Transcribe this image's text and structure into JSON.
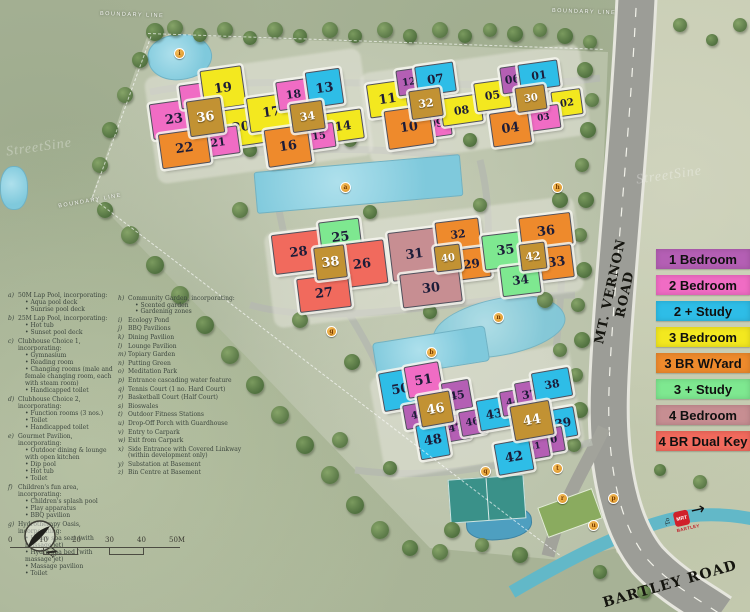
{
  "legend": {
    "items": [
      {
        "label": "1 Bedroom",
        "color": "#b45fb4"
      },
      {
        "label": "2 Bedroom",
        "color": "#f06cc4"
      },
      {
        "label": "2 + Study",
        "color": "#2ebde7"
      },
      {
        "label": "3 Bedroom",
        "color": "#f3e81f"
      },
      {
        "label": "3 BR W/Yard",
        "color": "#ee8a2c"
      },
      {
        "label": "3 + Study",
        "color": "#7ee890"
      },
      {
        "label": "4 Bedroom",
        "color": "#c78e92"
      },
      {
        "label": "4 BR Dual Key",
        "color": "#f16a5d"
      }
    ]
  },
  "unit_colors": {
    "1bed": "#b45fb4",
    "2bed": "#f06cc4",
    "2study": "#2ebde7",
    "3bed": "#f3e81f",
    "3yard": "#ee8a2c",
    "3study": "#7ee890",
    "4bed": "#c78e92",
    "4dual": "#f16a5d",
    "tower": "#c29233"
  },
  "roads": {
    "vernon": "MT. VERNON ROAD",
    "bartley": "BARTLEY ROAD",
    "mrt_to": "To",
    "mrt_logo": "MRT",
    "mrt_station": "BARTLEY",
    "mrt_arrow": "→"
  },
  "compass": {
    "north": "N"
  },
  "watermark": {
    "text": "StreetSine"
  },
  "scalebar": {
    "ticks": [
      "0",
      "10",
      "20",
      "30",
      "40",
      "50M"
    ]
  },
  "boundary_labels": [
    {
      "text": "BOUNDARY LINE",
      "x": 100,
      "y": 12,
      "r": 2
    },
    {
      "text": "BOUNDARY LINE",
      "x": 552,
      "y": 9,
      "r": 2
    },
    {
      "text": "BOUNDARY LINE",
      "x": 58,
      "y": 198,
      "r": -10
    }
  ],
  "buildings": [
    {
      "n": "23",
      "t": "2bed",
      "x": 151,
      "y": 101,
      "w": 44,
      "h": 34,
      "r": -8
    },
    {
      "n": "",
      "t": "2bed",
      "x": 180,
      "y": 84,
      "w": 22,
      "h": 22,
      "r": -8
    },
    {
      "n": "19",
      "t": "3bed",
      "x": 202,
      "y": 68,
      "w": 40,
      "h": 38,
      "r": -8
    },
    {
      "n": "20",
      "t": "3bed",
      "x": 219,
      "y": 108,
      "w": 42,
      "h": 36,
      "r": -8
    },
    {
      "n": "36",
      "t": "tower",
      "x": 188,
      "y": 99,
      "w": 33,
      "h": 34,
      "r": -8
    },
    {
      "n": "21",
      "t": "2bed",
      "x": 197,
      "y": 128,
      "w": 40,
      "h": 26,
      "r": -8
    },
    {
      "n": "22",
      "t": "3yard",
      "x": 160,
      "y": 131,
      "w": 47,
      "h": 33,
      "r": -8
    },
    {
      "n": "17",
      "t": "3bed",
      "x": 248,
      "y": 95,
      "w": 45,
      "h": 33,
      "r": -8
    },
    {
      "n": "18",
      "t": "2bed",
      "x": 277,
      "y": 80,
      "w": 31,
      "h": 27,
      "r": -8
    },
    {
      "n": "13",
      "t": "2study",
      "x": 307,
      "y": 70,
      "w": 33,
      "h": 34,
      "r": -8
    },
    {
      "n": "34",
      "t": "tower",
      "x": 291,
      "y": 102,
      "w": 31,
      "h": 27,
      "r": -8
    },
    {
      "n": "14",
      "t": "3bed",
      "x": 323,
      "y": 111,
      "w": 38,
      "h": 28,
      "r": -8
    },
    {
      "n": "15",
      "t": "2bed",
      "x": 303,
      "y": 124,
      "w": 30,
      "h": 23,
      "r": -8
    },
    {
      "n": "16",
      "t": "3yard",
      "x": 266,
      "y": 127,
      "w": 42,
      "h": 36,
      "r": -8
    },
    {
      "n": "11",
      "t": "3bed",
      "x": 368,
      "y": 82,
      "w": 37,
      "h": 32,
      "r": -8
    },
    {
      "n": "12",
      "t": "1bed",
      "x": 397,
      "y": 69,
      "w": 22,
      "h": 24,
      "r": -8
    },
    {
      "n": "07",
      "t": "2study",
      "x": 416,
      "y": 64,
      "w": 37,
      "h": 28,
      "r": -8
    },
    {
      "n": "32",
      "t": "tower",
      "x": 410,
      "y": 89,
      "w": 30,
      "h": 27,
      "r": -8
    },
    {
      "n": "09",
      "t": "2bed",
      "x": 421,
      "y": 110,
      "w": 28,
      "h": 25,
      "r": -8
    },
    {
      "n": "08",
      "t": "3bed",
      "x": 441,
      "y": 96,
      "w": 39,
      "h": 26,
      "r": -8
    },
    {
      "n": "10",
      "t": "3yard",
      "x": 386,
      "y": 108,
      "w": 44,
      "h": 37,
      "r": -8
    },
    {
      "n": "05",
      "t": "3bed",
      "x": 475,
      "y": 81,
      "w": 33,
      "h": 27,
      "r": -8
    },
    {
      "n": "06",
      "t": "1bed",
      "x": 501,
      "y": 66,
      "w": 21,
      "h": 25,
      "r": -8
    },
    {
      "n": "01",
      "t": "2study",
      "x": 519,
      "y": 62,
      "w": 38,
      "h": 25,
      "r": -8
    },
    {
      "n": "30",
      "t": "tower",
      "x": 516,
      "y": 86,
      "w": 28,
      "h": 23,
      "r": -8
    },
    {
      "n": "02",
      "t": "3bed",
      "x": 552,
      "y": 90,
      "w": 28,
      "h": 24,
      "r": -8
    },
    {
      "n": "03",
      "t": "2bed",
      "x": 527,
      "y": 106,
      "w": 31,
      "h": 22,
      "r": -8
    },
    {
      "n": "04",
      "t": "3yard",
      "x": 491,
      "y": 111,
      "w": 37,
      "h": 32,
      "r": -8
    },
    {
      "n": "28",
      "t": "4dual",
      "x": 273,
      "y": 232,
      "w": 49,
      "h": 38,
      "r": -7
    },
    {
      "n": "25",
      "t": "3study",
      "x": 320,
      "y": 220,
      "w": 39,
      "h": 33,
      "r": -7
    },
    {
      "n": "38",
      "t": "tower",
      "x": 315,
      "y": 246,
      "w": 29,
      "h": 31,
      "r": -7
    },
    {
      "n": "26",
      "t": "4dual",
      "x": 338,
      "y": 242,
      "w": 46,
      "h": 42,
      "r": -7
    },
    {
      "n": "27",
      "t": "4dual",
      "x": 298,
      "y": 276,
      "w": 50,
      "h": 32,
      "r": -7
    },
    {
      "n": "31",
      "t": "4bed",
      "x": 390,
      "y": 230,
      "w": 47,
      "h": 47,
      "r": -7
    },
    {
      "n": "32",
      "t": "3yard",
      "x": 436,
      "y": 220,
      "w": 42,
      "h": 27,
      "r": -7
    },
    {
      "n": "40",
      "t": "tower",
      "x": 435,
      "y": 245,
      "w": 24,
      "h": 24,
      "r": -7
    },
    {
      "n": "29",
      "t": "3yard",
      "x": 453,
      "y": 248,
      "w": 35,
      "h": 29,
      "r": -7
    },
    {
      "n": "30",
      "t": "4bed",
      "x": 401,
      "y": 271,
      "w": 58,
      "h": 32,
      "r": -7
    },
    {
      "n": "35",
      "t": "3study",
      "x": 483,
      "y": 233,
      "w": 43,
      "h": 33,
      "r": -7
    },
    {
      "n": "36",
      "t": "3yard",
      "x": 520,
      "y": 215,
      "w": 50,
      "h": 30,
      "r": -7
    },
    {
      "n": "42",
      "t": "tower",
      "x": 520,
      "y": 243,
      "w": 24,
      "h": 25,
      "r": -7
    },
    {
      "n": "33",
      "t": "3yard",
      "x": 540,
      "y": 246,
      "w": 31,
      "h": 31,
      "r": -7
    },
    {
      "n": "34",
      "t": "3study",
      "x": 501,
      "y": 265,
      "w": 37,
      "h": 28,
      "r": -7
    },
    {
      "n": "50",
      "t": "2study",
      "x": 381,
      "y": 370,
      "w": 37,
      "h": 37,
      "r": -10
    },
    {
      "n": "51",
      "t": "2bed",
      "x": 406,
      "y": 364,
      "w": 33,
      "h": 30,
      "r": -10
    },
    {
      "n": "45",
      "t": "1bed",
      "x": 443,
      "y": 381,
      "w": 26,
      "h": 27,
      "r": -10
    },
    {
      "n": "46",
      "t": "tower",
      "x": 419,
      "y": 393,
      "w": 31,
      "h": 30,
      "r": -10
    },
    {
      "n": "49",
      "t": "1bed",
      "x": 404,
      "y": 403,
      "w": 26,
      "h": 23,
      "r": -10
    },
    {
      "n": "47",
      "t": "1bed",
      "x": 442,
      "y": 415,
      "w": 25,
      "h": 24,
      "r": -10
    },
    {
      "n": "46",
      "t": "1bed",
      "x": 460,
      "y": 410,
      "w": 23,
      "h": 23,
      "r": -10
    },
    {
      "n": "48",
      "t": "2study",
      "x": 418,
      "y": 423,
      "w": 28,
      "h": 33,
      "r": -10
    },
    {
      "n": "43",
      "t": "2study",
      "x": 478,
      "y": 398,
      "w": 30,
      "h": 29,
      "r": -10
    },
    {
      "n": "44",
      "t": "1bed",
      "x": 501,
      "y": 390,
      "w": 22,
      "h": 23,
      "r": -10
    },
    {
      "n": "37",
      "t": "1bed",
      "x": 516,
      "y": 381,
      "w": 25,
      "h": 25,
      "r": -10
    },
    {
      "n": "38",
      "t": "2study",
      "x": 533,
      "y": 370,
      "w": 36,
      "h": 27,
      "r": -10
    },
    {
      "n": "44",
      "t": "tower",
      "x": 512,
      "y": 403,
      "w": 38,
      "h": 33,
      "r": -10
    },
    {
      "n": "39",
      "t": "2study",
      "x": 550,
      "y": 408,
      "w": 24,
      "h": 28,
      "r": -10
    },
    {
      "n": "40",
      "t": "1bed",
      "x": 537,
      "y": 428,
      "w": 25,
      "h": 23,
      "r": -10
    },
    {
      "n": "41",
      "t": "1bed",
      "x": 520,
      "y": 435,
      "w": 27,
      "h": 22,
      "r": -10
    },
    {
      "n": "42",
      "t": "2study",
      "x": 496,
      "y": 441,
      "w": 34,
      "h": 30,
      "r": -10
    }
  ],
  "amenity_markers": [
    {
      "l": "i",
      "x": 178,
      "y": 52
    },
    {
      "l": "a",
      "x": 344,
      "y": 186
    },
    {
      "l": "h",
      "x": 556,
      "y": 186
    },
    {
      "l": "g",
      "x": 330,
      "y": 330
    },
    {
      "l": "n",
      "x": 497,
      "y": 316
    },
    {
      "l": "b",
      "x": 430,
      "y": 351
    },
    {
      "l": "t",
      "x": 556,
      "y": 467
    },
    {
      "l": "q",
      "x": 484,
      "y": 470
    },
    {
      "l": "r",
      "x": 561,
      "y": 497
    },
    {
      "l": "p",
      "x": 612,
      "y": 497
    },
    {
      "l": "u",
      "x": 592,
      "y": 524
    }
  ],
  "facilities_left": [
    {
      "key": "a)",
      "title": "50M Lap Pool, incorporating:",
      "items": [
        "Aqua pool deck",
        "Sunrise pool deck"
      ]
    },
    {
      "key": "b)",
      "title": "25M Lap Pool, incorporating:",
      "items": [
        "Hot tub",
        "Sunset pool deck"
      ]
    },
    {
      "key": "c)",
      "title": "Clubhouse Choice 1, incorporating:",
      "items": [
        "Gymnasium",
        "Reading room",
        "Changing rooms (male and female changing room, each with steam room)",
        "Handicapped toilet"
      ]
    },
    {
      "key": "d)",
      "title": "Clubhouse Choice 2, incorporating:",
      "items": [
        "Function rooms (3 nos.)",
        "Toilet",
        "Handicapped toilet"
      ]
    },
    {
      "key": "e)",
      "title": "Gourmet Pavilion, incorporating:",
      "items": [
        "Outdoor dining & lounge with open kitchen",
        "Dip pool",
        "Hot tub",
        "Toilet"
      ]
    },
    {
      "key": "f)",
      "title": "Children's fun area, incorporating:",
      "items": [
        "Children's splash pool",
        "Play apparatus",
        "BBQ pavilion"
      ]
    },
    {
      "key": "g)",
      "title": "Hydrotherapy Oasis, incorporating:",
      "items": [
        "Hydro spa seat (with massage jet)",
        "Hydro spa bed (with massage jet)",
        "Massage pavilion",
        "Toilet"
      ]
    }
  ],
  "facilities_right": [
    {
      "key": "h)",
      "title": "Community Garden, incorporating:",
      "items": [
        "Scented garden",
        "Gardening zones"
      ]
    },
    {
      "key": "i)",
      "title": "Ecology Pond",
      "items": []
    },
    {
      "key": "j)",
      "title": "BBQ Pavilions",
      "items": []
    },
    {
      "key": "k)",
      "title": "Dining Pavilion",
      "items": []
    },
    {
      "key": "l)",
      "title": "Lounge Pavilion",
      "items": []
    },
    {
      "key": "m)",
      "title": "Topiary Garden",
      "items": []
    },
    {
      "key": "n)",
      "title": "Putting Green",
      "items": []
    },
    {
      "key": "o)",
      "title": "Meditation Park",
      "items": []
    },
    {
      "key": "p)",
      "title": "Entrance cascading water feature",
      "items": []
    },
    {
      "key": "q)",
      "title": "Tennis Court (1 no. Hard Court)",
      "items": []
    },
    {
      "key": "r)",
      "title": "Basketball Court (Half Court)",
      "items": []
    },
    {
      "key": "s)",
      "title": "Bioswales",
      "items": []
    },
    {
      "key": "t)",
      "title": "Outdoor Fitness Stations",
      "items": []
    },
    {
      "key": "u)",
      "title": "Drop-Off Porch with Guardhouse",
      "items": []
    },
    {
      "key": "v)",
      "title": "Entry to Carpark",
      "items": []
    },
    {
      "key": "w)",
      "title": "Exit from Carpark",
      "items": []
    },
    {
      "key": "x)",
      "title": "Side Entrance with Covered Linkway (within development only)",
      "items": []
    },
    {
      "key": "y)",
      "title": "Substation at Basement",
      "items": []
    },
    {
      "key": "z)",
      "title": "Bin Centre at Basement",
      "items": []
    }
  ]
}
